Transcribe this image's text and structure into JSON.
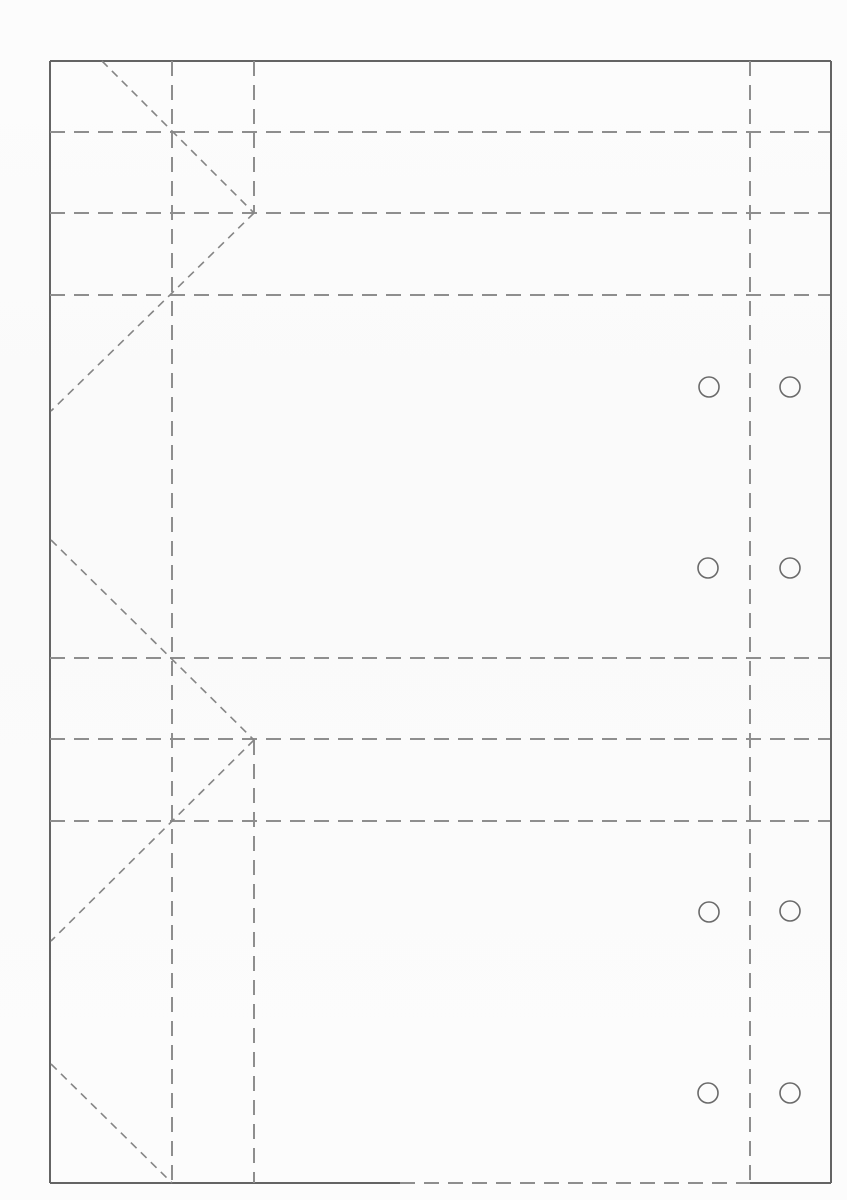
{
  "page": {
    "width": 847,
    "height": 1200,
    "background": "#fcfcfc"
  },
  "diagram": {
    "kind": "fold-and-cut-template",
    "styles": {
      "cut": {
        "color": "#646464",
        "width": 2,
        "dash": null
      },
      "fold": {
        "color": "#8e8e8e",
        "width": 2,
        "dash": "15,9"
      },
      "diag": {
        "color": "#858585",
        "width": 1.6,
        "dash": "8,6"
      }
    },
    "hole_style": {
      "color": "#6a6a6a",
      "width": 1.6,
      "radius": 10,
      "fill": "none"
    },
    "lines": [
      {
        "name": "cut-top-edge",
        "style": "cut",
        "x1": 50,
        "y1": 61,
        "x2": 831,
        "y2": 61
      },
      {
        "name": "cut-left-edge",
        "style": "cut",
        "x1": 50,
        "y1": 61,
        "x2": 50,
        "y2": 1183
      },
      {
        "name": "cut-right-edge",
        "style": "cut",
        "x1": 831,
        "y1": 61,
        "x2": 831,
        "y2": 1183
      },
      {
        "name": "cut-bottom-edge-left",
        "style": "cut",
        "x1": 50,
        "y1": 1183,
        "x2": 400,
        "y2": 1183
      },
      {
        "name": "fold-bottom-edge-middle",
        "style": "fold",
        "x1": 400,
        "y1": 1183,
        "x2": 750,
        "y2": 1183
      },
      {
        "name": "cut-bottom-edge-right",
        "style": "cut",
        "x1": 750,
        "y1": 1183,
        "x2": 831,
        "y2": 1183
      },
      {
        "name": "fold-vertical-inner-left",
        "style": "fold",
        "x1": 172,
        "y1": 61,
        "x2": 172,
        "y2": 1183
      },
      {
        "name": "fold-vertical-gusset-top",
        "style": "fold",
        "x1": 254,
        "y1": 61,
        "x2": 254,
        "y2": 213
      },
      {
        "name": "fold-vertical-gusset-bottom",
        "style": "fold",
        "x1": 254,
        "y1": 740,
        "x2": 254,
        "y2": 1183
      },
      {
        "name": "fold-vertical-inner-right",
        "style": "fold",
        "x1": 750,
        "y1": 61,
        "x2": 750,
        "y2": 1183
      },
      {
        "name": "fold-horizontal-1",
        "style": "fold",
        "x1": 50,
        "y1": 132,
        "x2": 830,
        "y2": 132
      },
      {
        "name": "fold-horizontal-2",
        "style": "fold",
        "x1": 50,
        "y1": 213,
        "x2": 830,
        "y2": 213
      },
      {
        "name": "fold-horizontal-3",
        "style": "fold",
        "x1": 50,
        "y1": 295,
        "x2": 830,
        "y2": 295
      },
      {
        "name": "fold-horizontal-4",
        "style": "fold",
        "x1": 50,
        "y1": 658,
        "x2": 830,
        "y2": 658
      },
      {
        "name": "fold-horizontal-5",
        "style": "fold",
        "x1": 50,
        "y1": 739,
        "x2": 830,
        "y2": 739
      },
      {
        "name": "fold-horizontal-6",
        "style": "fold",
        "x1": 50,
        "y1": 821,
        "x2": 830,
        "y2": 821
      },
      {
        "name": "fold-diagonal-1",
        "style": "diag",
        "x1": 102,
        "y1": 61,
        "x2": 254,
        "y2": 213
      },
      {
        "name": "fold-diagonal-2",
        "style": "diag",
        "x1": 254,
        "y1": 213,
        "x2": 51,
        "y2": 411
      },
      {
        "name": "fold-diagonal-3",
        "style": "diag",
        "x1": 51,
        "y1": 540,
        "x2": 254,
        "y2": 740
      },
      {
        "name": "fold-diagonal-4",
        "style": "diag",
        "x1": 254,
        "y1": 740,
        "x2": 51,
        "y2": 941
      },
      {
        "name": "fold-diagonal-5",
        "style": "diag",
        "x1": 51,
        "y1": 1064,
        "x2": 172,
        "y2": 1183
      }
    ],
    "holes": [
      {
        "name": "punch-hole-top-left-1",
        "cx": 709,
        "cy": 387
      },
      {
        "name": "punch-hole-top-right-1",
        "cx": 790,
        "cy": 387
      },
      {
        "name": "punch-hole-top-left-2",
        "cx": 708,
        "cy": 568
      },
      {
        "name": "punch-hole-top-right-2",
        "cx": 790,
        "cy": 568
      },
      {
        "name": "punch-hole-bottom-left-1",
        "cx": 709,
        "cy": 912
      },
      {
        "name": "punch-hole-bottom-right-1",
        "cx": 790,
        "cy": 911
      },
      {
        "name": "punch-hole-bottom-left-2",
        "cx": 708,
        "cy": 1093
      },
      {
        "name": "punch-hole-bottom-right-2",
        "cx": 790,
        "cy": 1093
      }
    ]
  }
}
